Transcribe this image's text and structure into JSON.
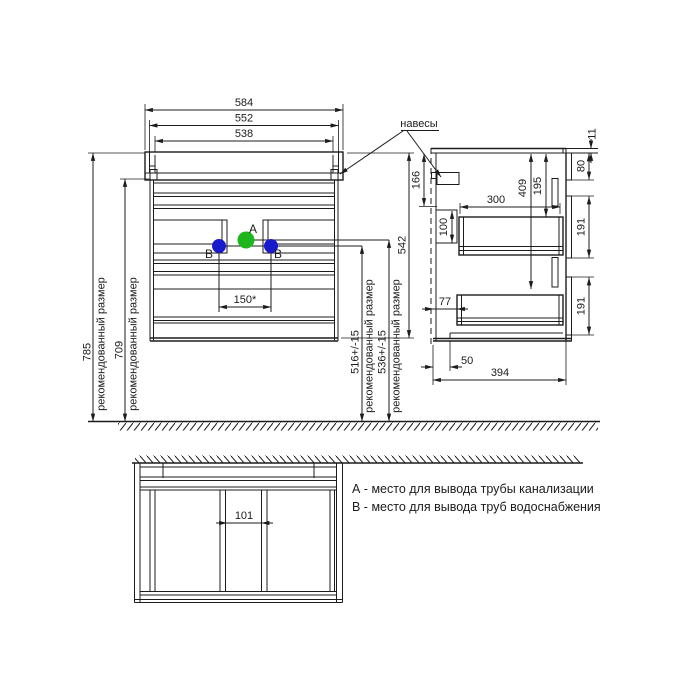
{
  "views": {
    "front": {
      "top_widths": {
        "outer": "584",
        "mid": "552",
        "inner": "538"
      },
      "heights": {
        "floor_to_top": "785",
        "floor_to_body": "709",
        "cabinet": "542",
        "pipe_a_floor": "536+/-15",
        "pipe_b_floor": "516+/-15",
        "recommended_note": "рекомендованный размер"
      },
      "pipe_spacing": "150*",
      "points": {
        "a": "A",
        "b_left": "B",
        "b_right": "B"
      }
    },
    "side": {
      "hangers_label": "навесы",
      "countertop_thickness": "11",
      "top_rail_height": "80",
      "drawer_front_top": "191",
      "drawer_front_bottom": "191",
      "hanger_offset": "166",
      "drawer_depth": "300",
      "back_rail_height": "100",
      "slide_bottom_offset": "409",
      "slide_top_offset": "195",
      "back_gap": "77",
      "plinth_inset": "50",
      "depth_total": "394"
    },
    "bottom": {
      "pipe_channel_width": "101"
    }
  },
  "legend": {
    "a": "А - место для вывода трубы канализации",
    "b": "В - место для вывода труб водоснабжения"
  },
  "colors": {
    "ink": "#1c1c1c",
    "point_a": "#1db71d",
    "point_b": "#1a1acd",
    "background": "#ffffff"
  }
}
